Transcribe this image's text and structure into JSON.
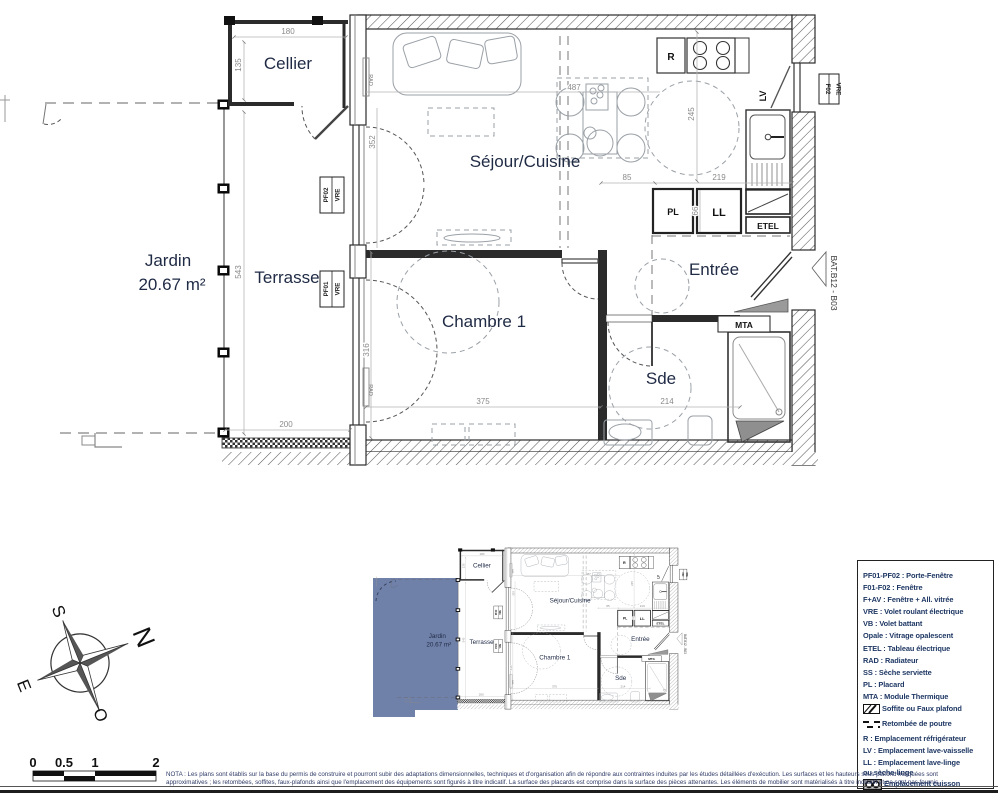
{
  "colors": {
    "jardin_fill": "#6F80A9",
    "label_color": "#1F2A44",
    "legend_text": "#1F3864"
  },
  "plan": {
    "rooms": {
      "cellier": "Cellier",
      "sejour_cuisine": "Séjour/Cuisine",
      "jardin": "Jardin",
      "jardin_area": "20.67 m²",
      "terrasse": "Terrasse",
      "chambre1": "Chambre 1",
      "entree": "Entrée",
      "sde": "Sde"
    },
    "tags": {
      "pf02": "PF02",
      "pf01": "PF01",
      "f02": "F02",
      "vre": "VRE",
      "bat": "BAT.B12 - B03",
      "rad": "RAD",
      "mta": "MTA",
      "r": "R",
      "lv": "LV",
      "pl": "PL",
      "ll": "LL",
      "etel": "ETEL"
    },
    "dims": {
      "d180": "180",
      "d135": "135",
      "d543": "543",
      "d352": "352",
      "d487": "487",
      "d245": "245",
      "d85": "85",
      "d219": "219",
      "d66": "66",
      "d316": "316",
      "d375": "375",
      "d214": "214",
      "d200": "200"
    }
  },
  "compass": {
    "north": "N",
    "south": "S",
    "east": "E",
    "west": "O"
  },
  "scale_bar": {
    "ticks": [
      "0",
      "0.5",
      "1",
      "2"
    ]
  },
  "nota": {
    "line1": "NOTA : Les plans sont établis sur la base du permis de construire et pourront subir des adaptations dimensionnelles, techniques et d'organisation afin de répondre aux contraintes induites par les études détaillées d'exécution. Les surfaces et les hauteurs sous plafond indiquées sont",
    "line2": "approximatives ; les retombées, soffites, faux-plafonds ainsi que l'emplacement des équipements sont figurés à titre indicatif. La surface des placards est comprise dans la surface des pièces attenantes. Les éléments de mobilier sont matérialisés à titre indicatif et ne sont pas fournis."
  },
  "legend": {
    "items": [
      {
        "label": "PF01-PF02 : Porte-Fenêtre"
      },
      {
        "label": "F01-F02 : Fenêtre"
      },
      {
        "label": "F+AV : Fenêtre + All. vitrée"
      },
      {
        "label": "VRE : Volet roulant électrique"
      },
      {
        "label": "VB : Volet battant"
      },
      {
        "label": "Opale : Vitrage opalescent"
      },
      {
        "label": "ETEL : Tableau électrique"
      },
      {
        "label": "RAD : Radiateur"
      },
      {
        "label": "SS : Sèche serviette"
      },
      {
        "label": "PL : Placard"
      },
      {
        "label": "MTA : Module Thermique"
      },
      {
        "label": "Soffite ou Faux plafond"
      },
      {
        "label": "Retombée de poutre"
      },
      {
        "label": "R : Emplacement réfrigérateur"
      },
      {
        "label": "LV : Emplacement lave-vaisselle"
      },
      {
        "label": "LL : Emplacement lave-linge\n      ou sèche-linge"
      },
      {
        "label": "Emplacement cuisson"
      }
    ]
  }
}
